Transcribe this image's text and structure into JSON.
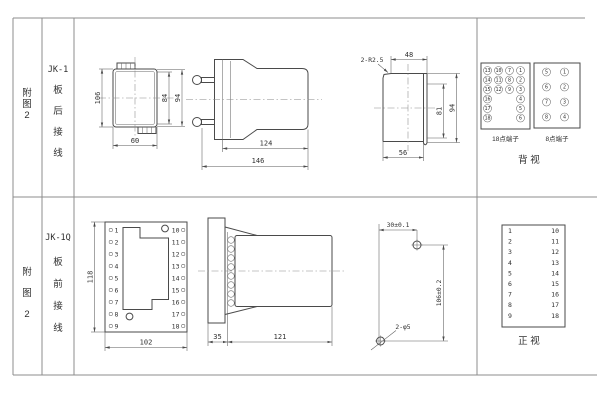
{
  "sidebar": {
    "figure_label_chars": [
      "附",
      "图",
      "2"
    ]
  },
  "rows": [
    {
      "model": "JK-1",
      "wiring_chars": [
        "板",
        "后",
        "接",
        "线"
      ],
      "front_view": {
        "dim_height": "106",
        "dim_inner": "84",
        "dim_outer": "94",
        "dim_width": "60"
      },
      "side_view": {
        "dim_body": "124",
        "dim_total": "146"
      },
      "cutout": {
        "corner_note": "2-R2.5",
        "dim_top": "48",
        "dim_inner": "81",
        "dim_outer": "94",
        "dim_bottom": "56"
      },
      "terminals18": {
        "label": "18点端子",
        "rows4": [
          [
            "13",
            "10",
            "7",
            "1"
          ],
          [
            "14",
            "11",
            "8",
            "2"
          ],
          [
            "15",
            "12",
            "9",
            "3"
          ]
        ],
        "rows2": [
          [
            "16",
            "4"
          ],
          [
            "17",
            "5"
          ],
          [
            "18",
            "6"
          ]
        ]
      },
      "terminals8": {
        "label": "8点端子",
        "left": [
          "5",
          "6",
          "7",
          "8"
        ],
        "right": [
          "1",
          "2",
          "3",
          "4"
        ]
      },
      "view_label": "背 视"
    },
    {
      "model": "JK-1Q",
      "wiring_chars": [
        "板",
        "前",
        "接",
        "线"
      ],
      "front_view": {
        "dim_height": "118",
        "dim_width": "102",
        "left_terminals": [
          "1",
          "2",
          "3",
          "4",
          "5",
          "6",
          "7",
          "8",
          "9"
        ],
        "right_terminals": [
          "10",
          "11",
          "12",
          "13",
          "14",
          "15",
          "16",
          "17",
          "18"
        ]
      },
      "side_view": {
        "dim_plate": "35",
        "dim_body": "121"
      },
      "drilling": {
        "dim_horizontal": "30±0.1",
        "dim_vertical": "106±0.2",
        "hole_note": "2-φ5"
      },
      "terminal_table": {
        "left": [
          "1",
          "2",
          "3",
          "4",
          "5",
          "6",
          "7",
          "8",
          "9"
        ],
        "right": [
          "10",
          "11",
          "12",
          "13",
          "14",
          "15",
          "16",
          "17",
          "18"
        ]
      },
      "view_label": "正 视"
    }
  ]
}
